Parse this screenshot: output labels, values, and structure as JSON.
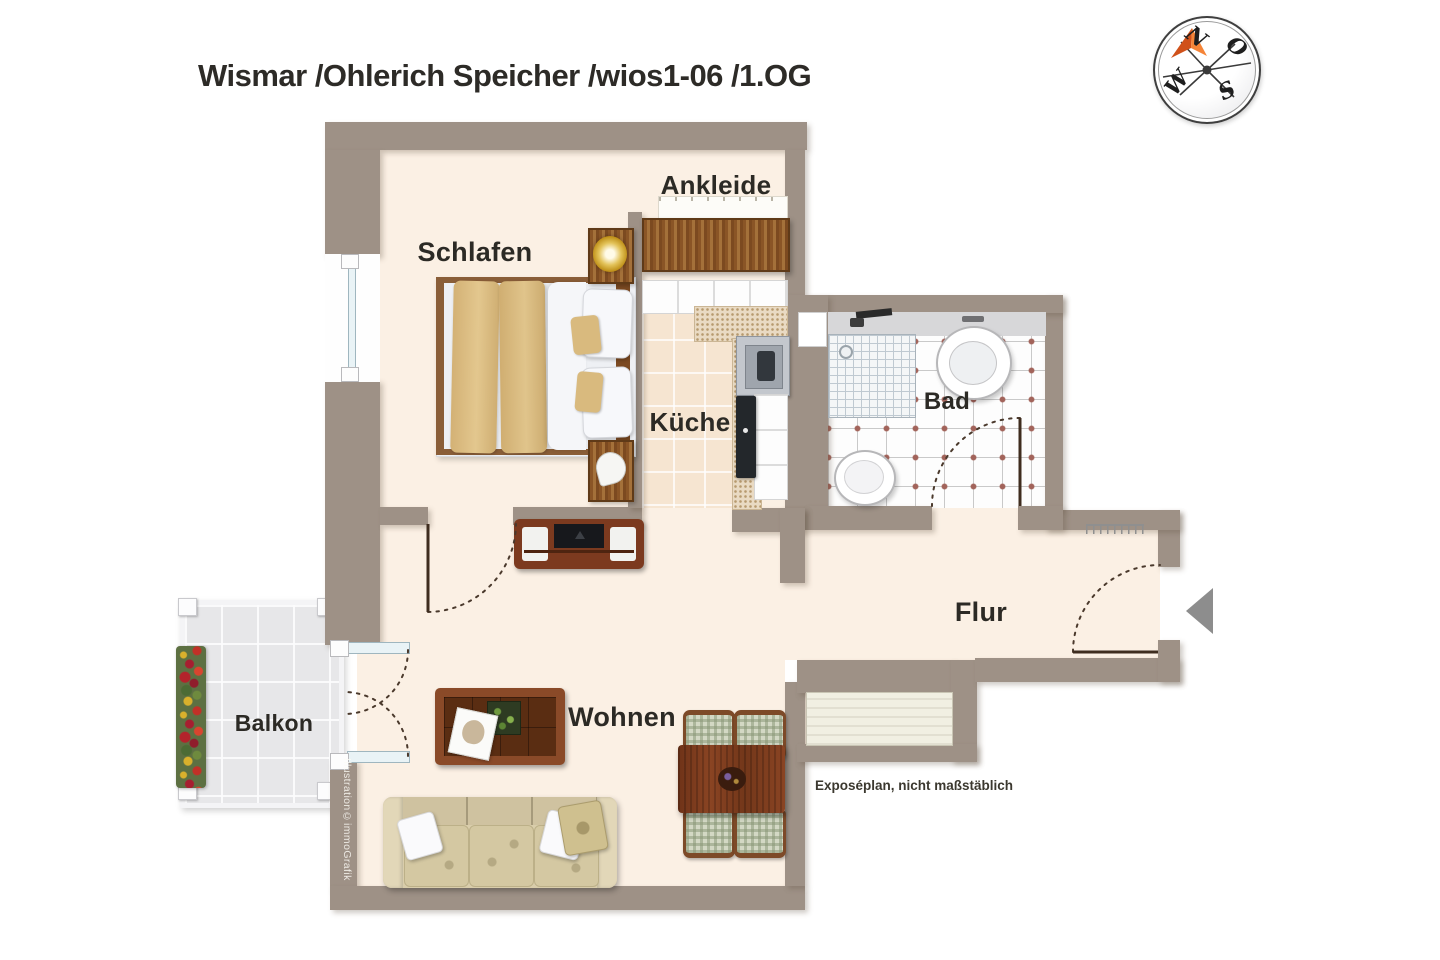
{
  "title": "Wismar /Ohlerich Speicher /wios1-06 /1.OG",
  "rooms": {
    "schlafen": "Schlafen",
    "ankleide": "Ankleide",
    "kueche": "Küche",
    "bad": "Bad",
    "flur": "Flur",
    "wohnen": "Wohnen",
    "balkon": "Balkon"
  },
  "compass": {
    "north": "N",
    "east": "O",
    "south": "S",
    "west": "W"
  },
  "notes": {
    "disclaimer": "Exposéplan, nicht maßstäblich",
    "credit": "Illustration©immoGrafik"
  },
  "colors": {
    "wall": "#9e9186",
    "floor": "#fbf0e4",
    "kitchen_tile": "#f6e5d1",
    "bath_tile_dot": "#a2635a",
    "balcony_tile": "#e7e7e9",
    "wood_dark": "#7c3a1f",
    "wood_light": "#96622f",
    "blanket_tan": "#dcbd80",
    "compass_arrow": "#e8621f",
    "entrance_arrow": "#8d8d8d"
  }
}
